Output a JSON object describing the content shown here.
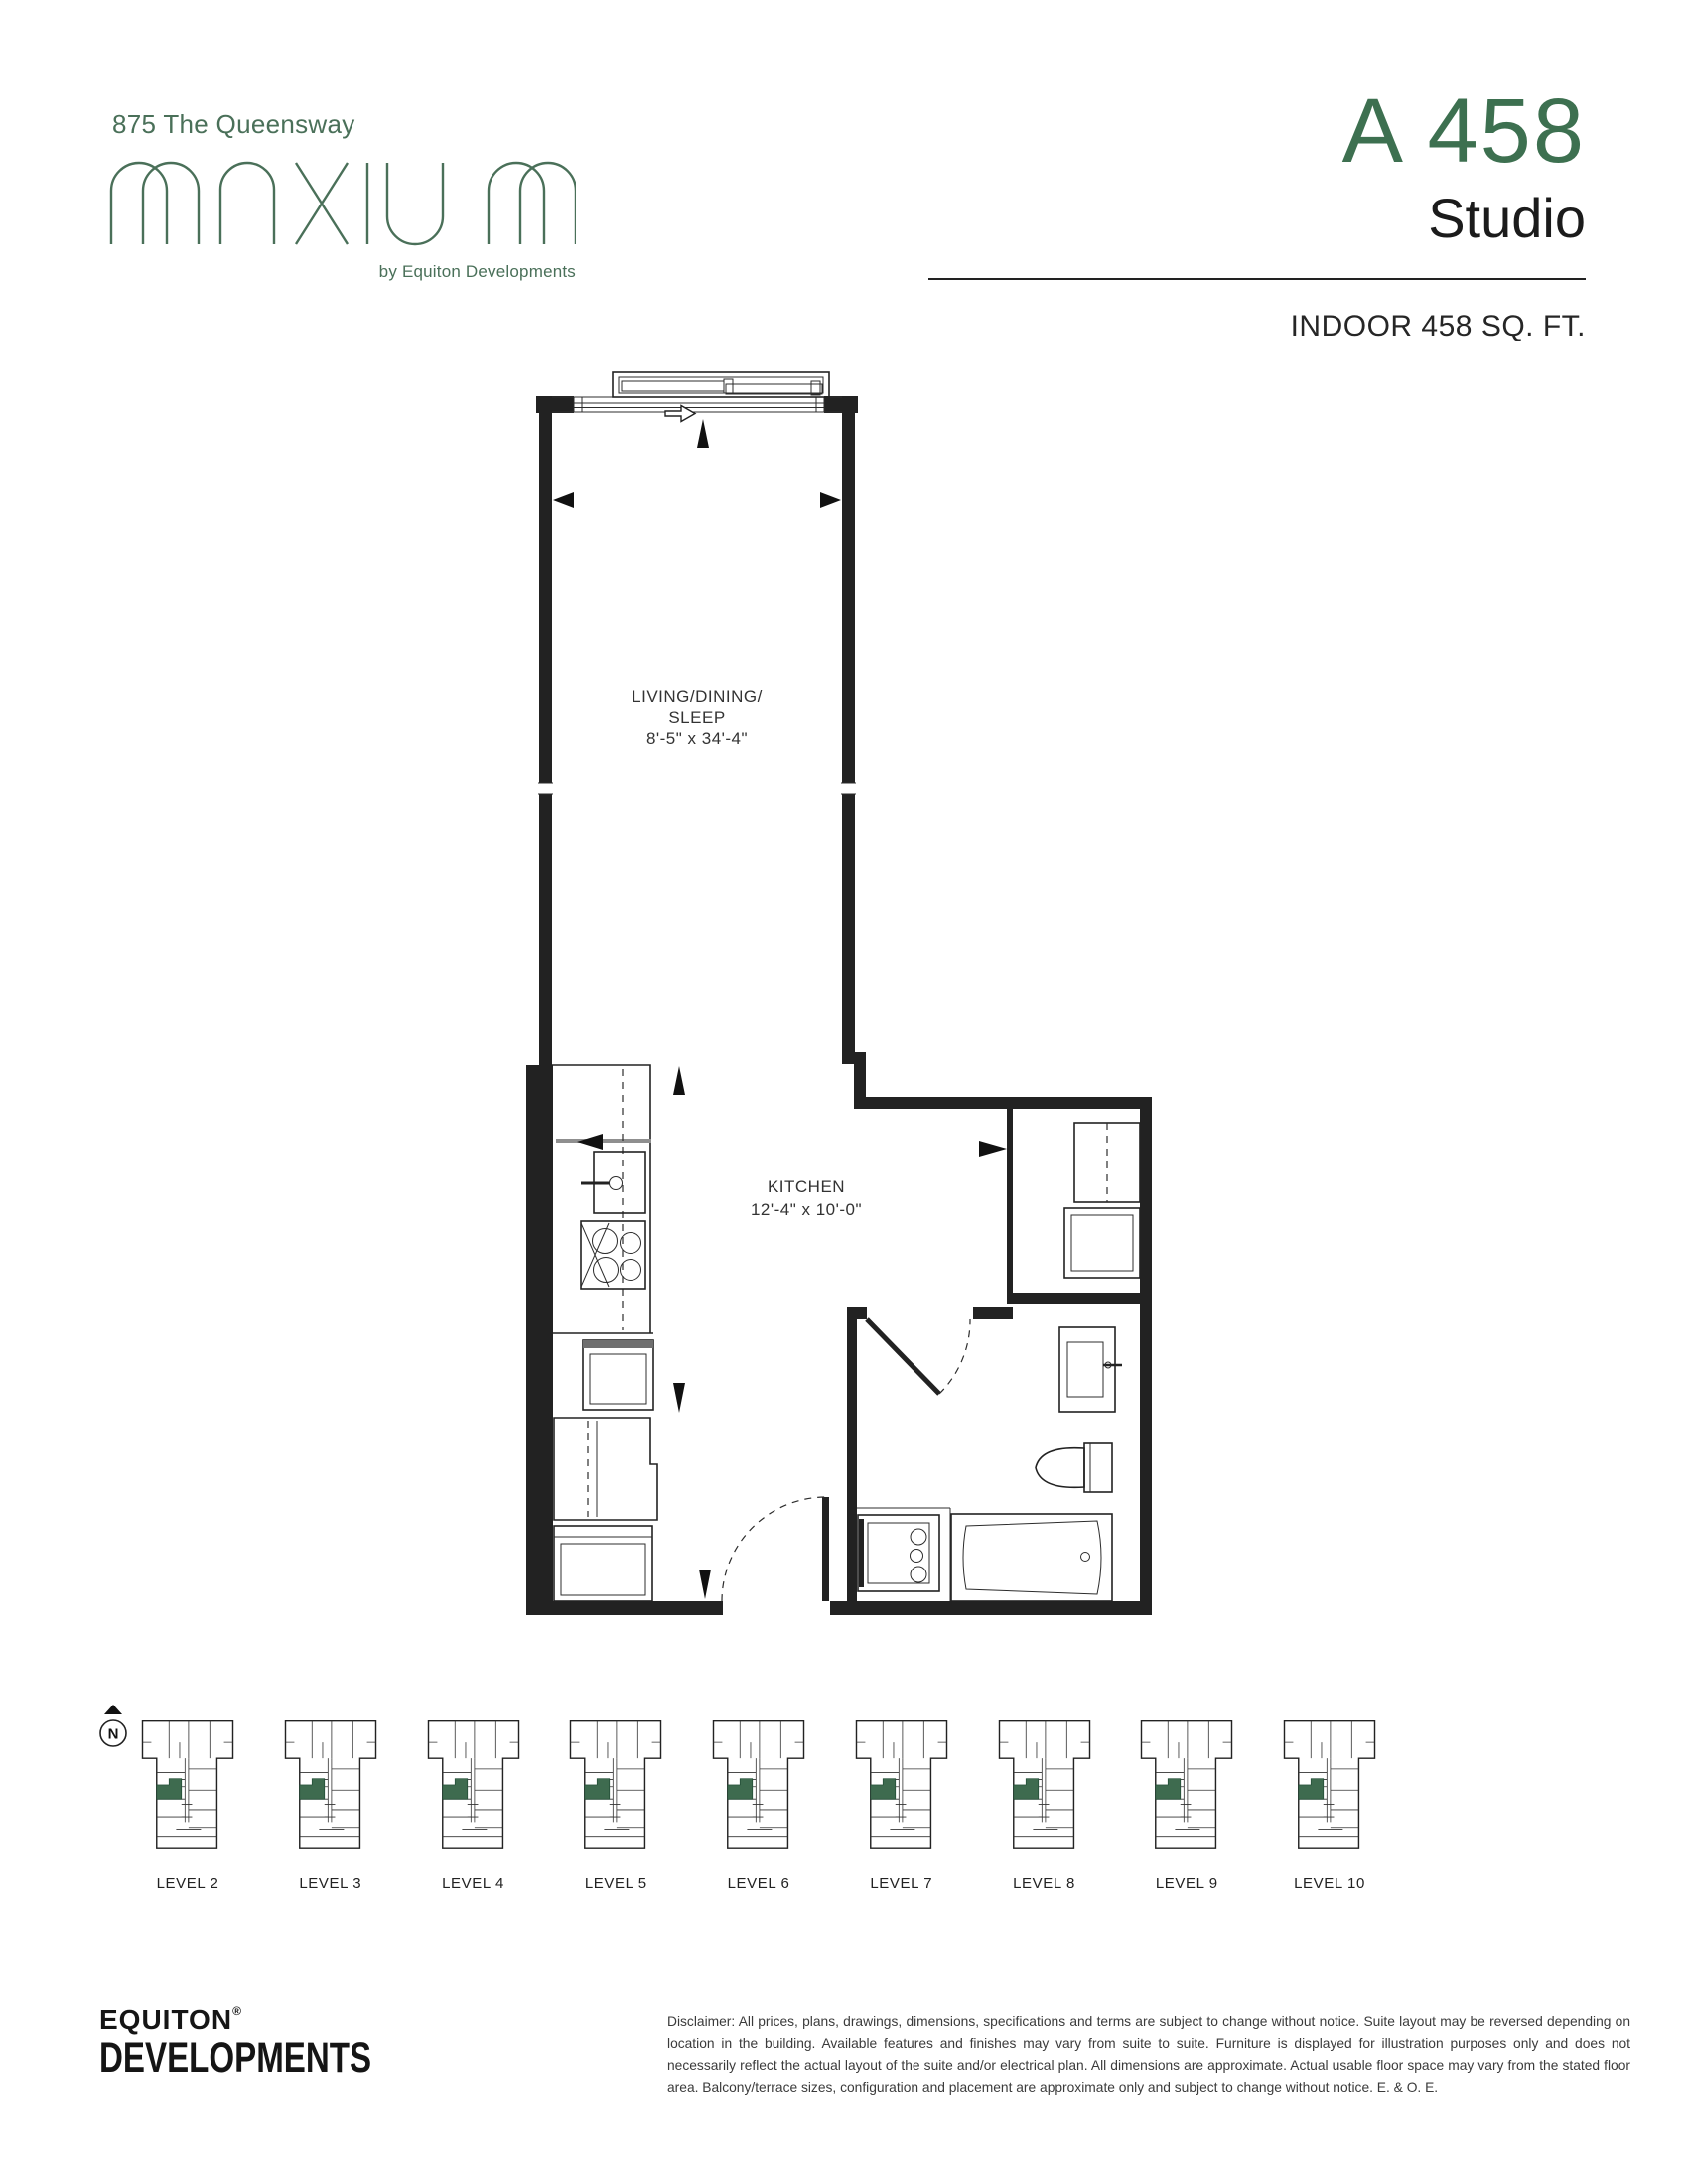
{
  "brand": {
    "address": "875 The Queensway",
    "wordmark": "MAXIUM",
    "tagline": "by Equiton Developments"
  },
  "unit": {
    "code": "A 458",
    "type": "Studio",
    "area": "INDOOR 458 SQ. FT."
  },
  "plan": {
    "living": {
      "line1": "LIVING/DINING/",
      "line2": "SLEEP",
      "dims": "8'-5\" x 34'-4\""
    },
    "kitchen": {
      "name": "KITCHEN",
      "dims": "12'-4\" x 10'-0\""
    }
  },
  "levels": {
    "compass": "N",
    "labels": [
      "LEVEL 2",
      "LEVEL 3",
      "LEVEL 4",
      "LEVEL 5",
      "LEVEL 6",
      "LEVEL 7",
      "LEVEL 8",
      "LEVEL 9",
      "LEVEL 10"
    ]
  },
  "footer": {
    "company_line1": "EQUITON",
    "company_reg": "®",
    "company_line2": "DEVELOPMENTS",
    "disclaimer": "Disclaimer: All prices, plans, drawings, dimensions, specifications and terms are subject to change without notice. Suite layout may be reversed depending on location in the building. Available features and finishes may vary from suite to suite. Furniture is displayed for illustration purposes only and does not necessarily reflect the actual layout of the suite and/or electrical plan. All dimensions are approximate. Actual usable floor space may vary from the stated floor area. Balcony/terrace sizes, configuration and placement are approximate only and subject to change without notice. E. & O. E."
  },
  "colors": {
    "brand_green": "#4A7059",
    "title_green": "#3D7050",
    "suite_highlight": "#3E6B4F"
  }
}
